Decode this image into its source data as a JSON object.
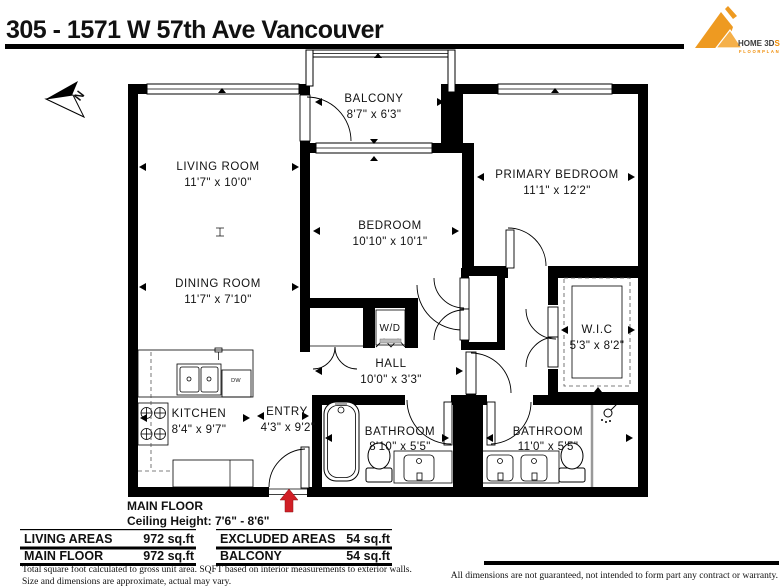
{
  "header": {
    "title": "305 - 1571 W 57th Ave Vancouver",
    "logo": {
      "name": "HOME 3D",
      "accent": "S",
      "subtitle": "FLOORPLAN"
    }
  },
  "north": {
    "label": "N"
  },
  "rooms": {
    "living": {
      "name": "LIVING ROOM",
      "dims": "11'7\" x 10'0\""
    },
    "dining": {
      "name": "DINING ROOM",
      "dims": "11'7\" x 7'10\""
    },
    "kitchen": {
      "name": "KITCHEN",
      "dims": "8'4\" x 9'7\""
    },
    "entry": {
      "name": "ENTRY",
      "dims": "4'3\" x 9'2\""
    },
    "bedroom": {
      "name": "BEDROOM",
      "dims": "10'10\" x 10'1\""
    },
    "hall": {
      "name": "HALL",
      "dims": "10'0\" x 3'3\""
    },
    "balcony": {
      "name": "BALCONY",
      "dims": "8'7\" x 6'3\""
    },
    "primary": {
      "name": "PRIMARY BEDROOM",
      "dims": "11'1\" x 12'2\""
    },
    "wic": {
      "name": "W.I.C",
      "dims": "5'3\" x 8'2\""
    },
    "bath1": {
      "name": "BATHROOM",
      "dims": "8'10\" x 5'5\""
    },
    "bath2": {
      "name": "BATHROOM",
      "dims": "11'0\" x 5'5\""
    }
  },
  "fixtures": {
    "wd_label": "W/D",
    "dw_label": "DW"
  },
  "caption": {
    "floor": "MAIN FLOOR",
    "ceiling": "Ceiling Height: 7'6\" - 8'6\""
  },
  "tables": {
    "living": {
      "header": {
        "label": "LIVING AREAS",
        "value": "972 sq.ft"
      },
      "rows": [
        {
          "label": "MAIN FLOOR",
          "value": "972 sq.ft"
        }
      ]
    },
    "excluded": {
      "header": {
        "label": "EXCLUDED AREAS",
        "value": "54 sq.ft"
      },
      "rows": [
        {
          "label": "BALCONY",
          "value": "54 sq.ft"
        }
      ]
    }
  },
  "footnotes": [
    "Total square foot calculated to gross unit area. SQFT based on interior measurements to exterior walls.",
    "Size and dimensions are approximate, actual may vary."
  ],
  "disclaimer": "All dimensions are not guaranteed, not intended to form part any contract or warranty.",
  "colors": {
    "wall": "#000000",
    "logo_orange": "#ee9a21",
    "logo_orange_light": "#f5b04a",
    "entry_arrow_red": "#d11f26",
    "text": "#111111"
  }
}
